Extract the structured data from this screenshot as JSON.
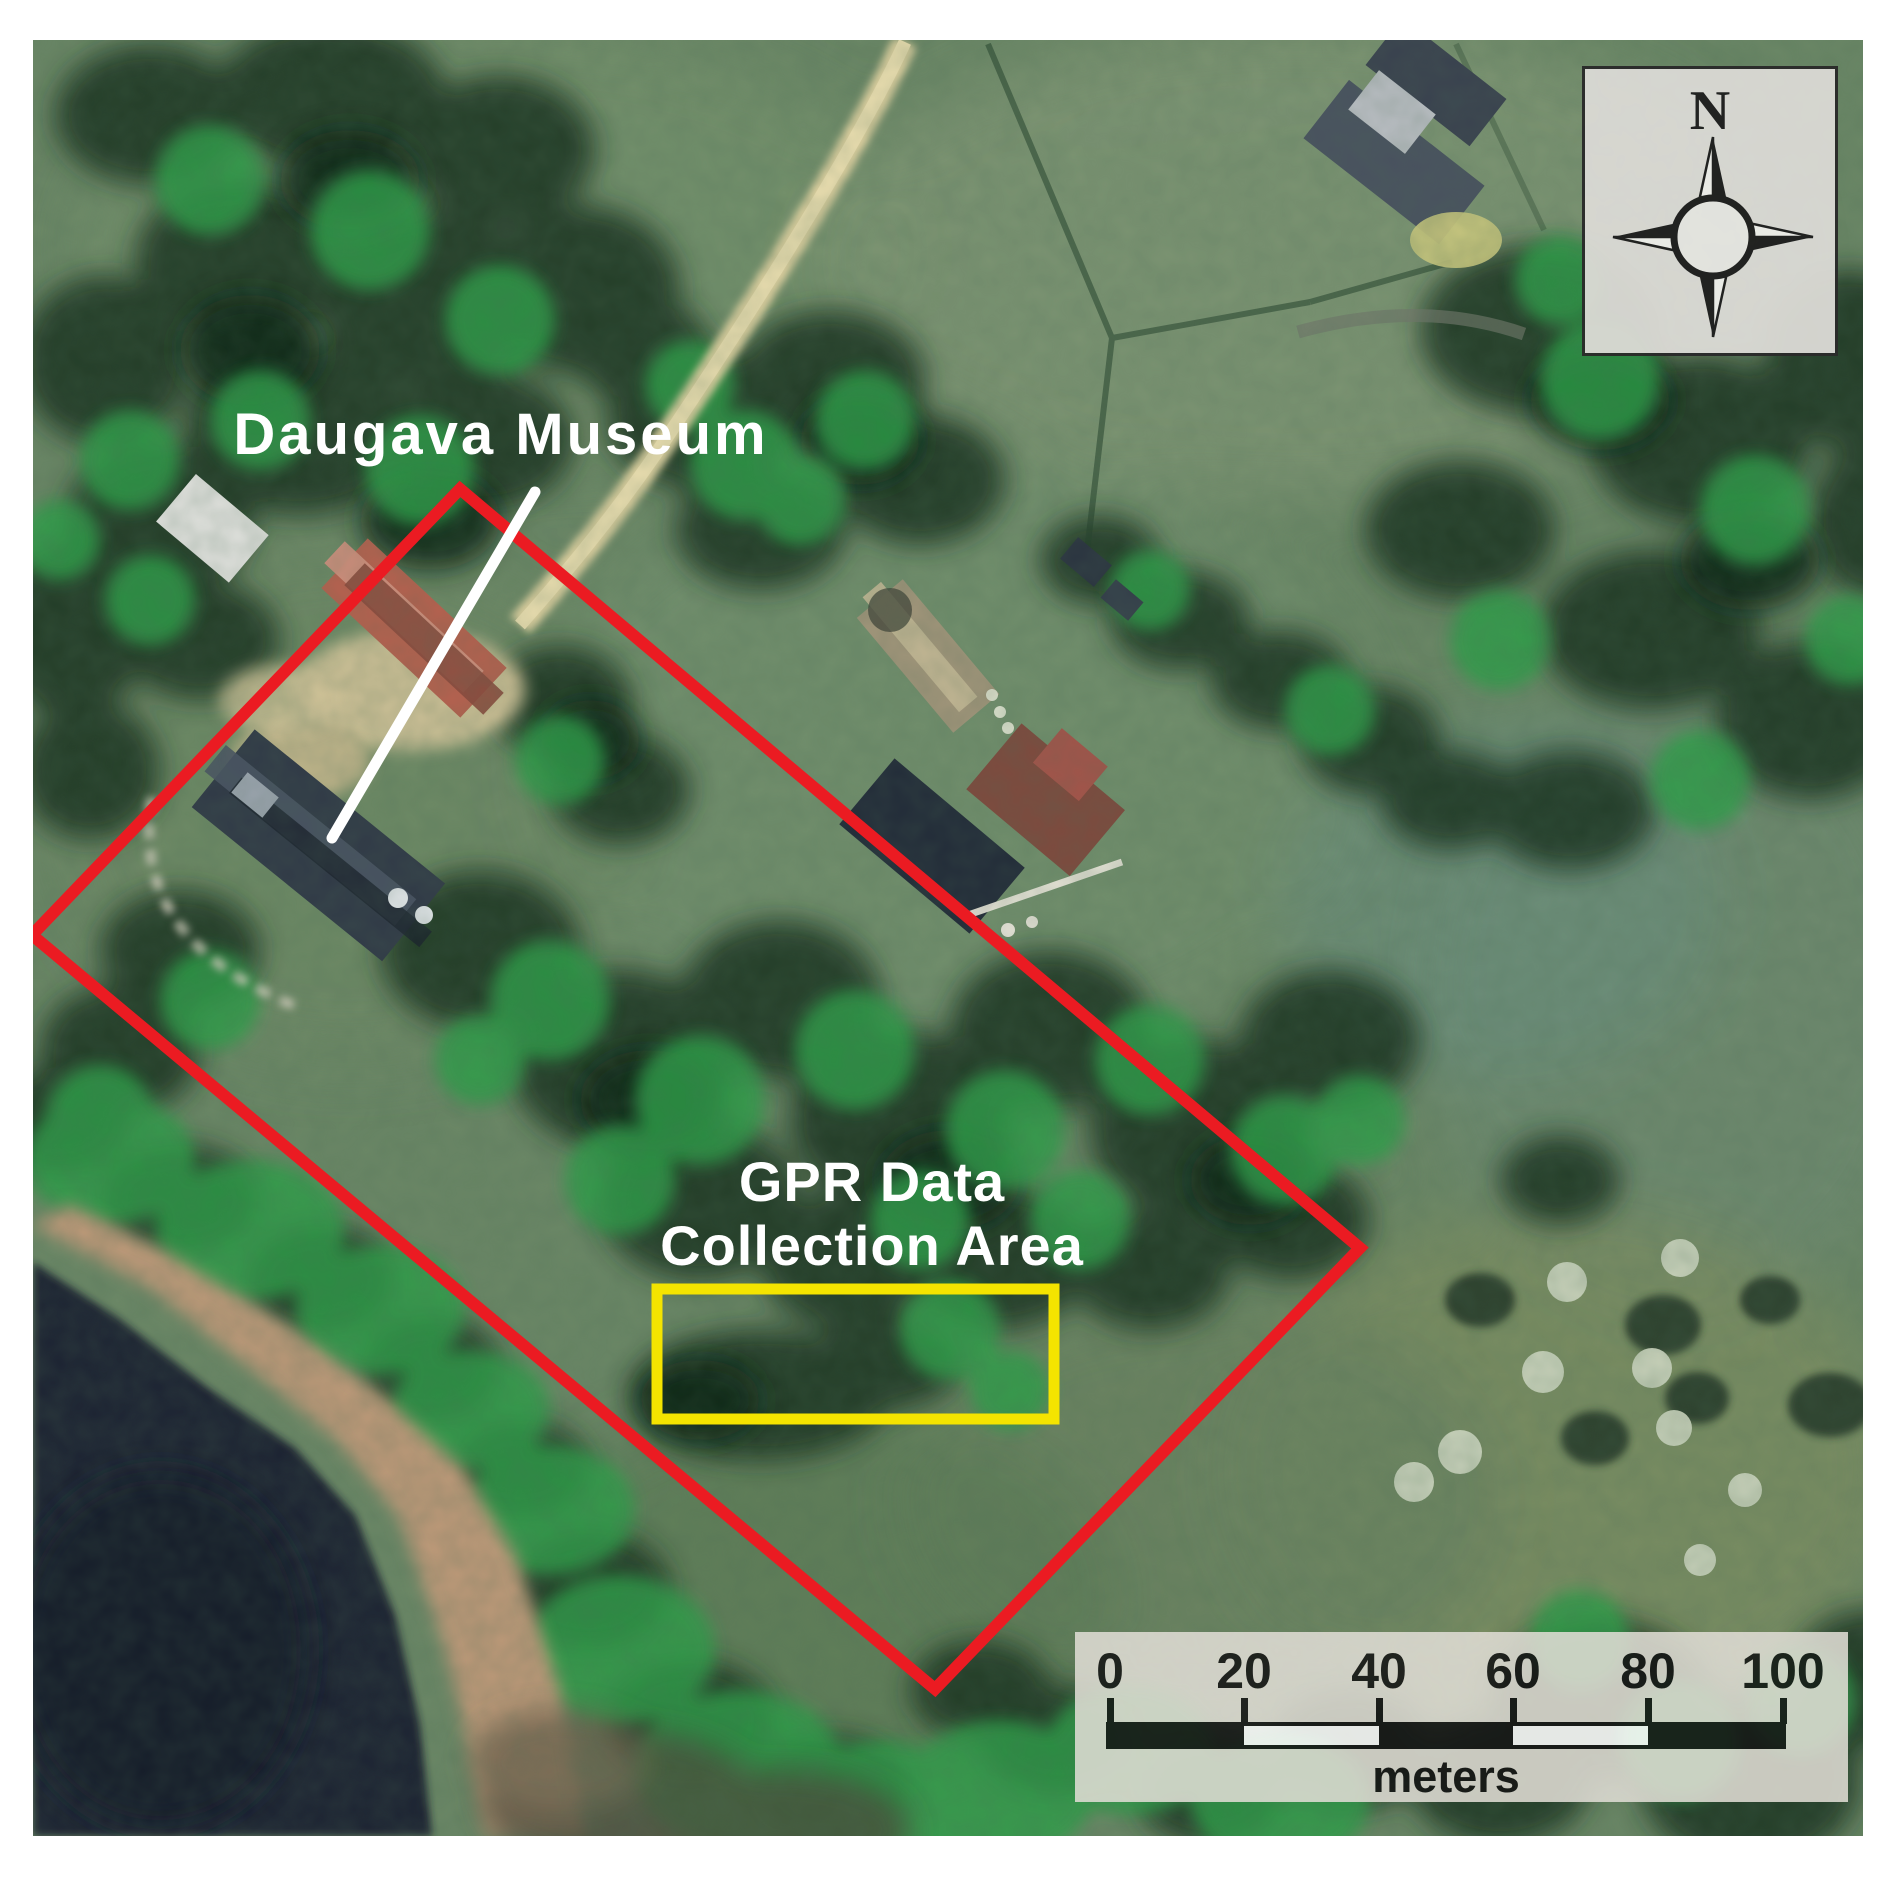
{
  "map": {
    "museum_label": "Daugava Museum",
    "gpr_area_label_line1": "GPR Data",
    "gpr_area_label_line2": "Collection Area"
  },
  "compass": {
    "north_label": "N",
    "icon": "compass-rose-star"
  },
  "scale_bar": {
    "tick_labels": [
      "0",
      "20",
      "40",
      "60",
      "80",
      "100"
    ],
    "unit_label": "meters"
  },
  "colors": {
    "survey_boundary": "#eb1b22",
    "gpr_area_outline": "#f4e400",
    "annotation_text": "#ffffff",
    "leader_line": "#ffffff",
    "ink": "#161616",
    "scale_panel_bg": "#dfdcd4",
    "compass_panel_bg": "#dad9d4"
  }
}
